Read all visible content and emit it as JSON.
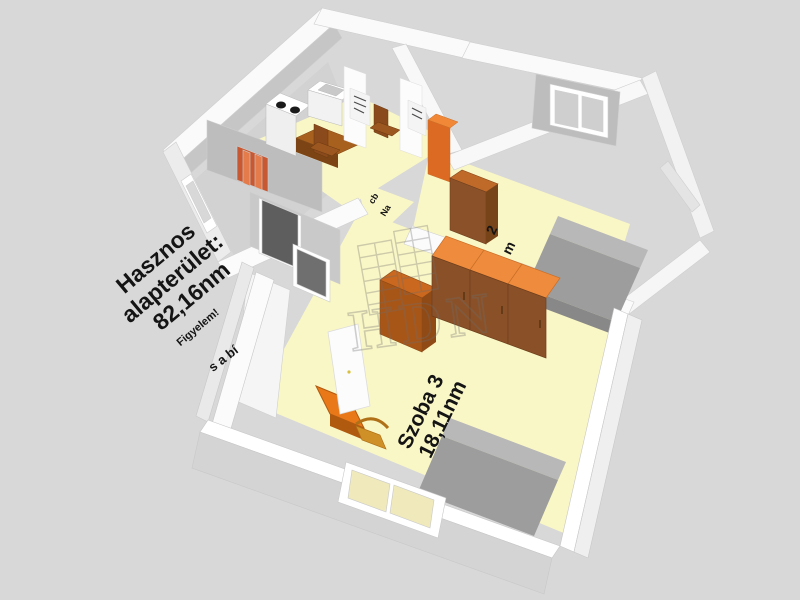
{
  "scene": {
    "background": "#D8D8D8",
    "description": "3D apartment floor plan render"
  },
  "labels": {
    "main_area": {
      "line1": "Hasznos",
      "line2": "alapterület:",
      "line3": "82,16nm"
    },
    "warning": "Figyelem!",
    "wall_text_fragment": "s a bí",
    "room3": {
      "name": "Szoba 3",
      "area": "18,11nm"
    },
    "room2_fragment": {
      "char1": "2",
      "char2": "m"
    },
    "hall_fragment": {
      "part1": "cb",
      "part2": "Na"
    }
  },
  "watermark": {
    "text": "HDN"
  },
  "palette": {
    "background": "#D8D8D8",
    "floor_yellow": "#FAF7C6",
    "wall_white": "#FFFFFF",
    "wall_shadow": "#C6C6C6",
    "furniture_orange_top": "#EF8B3D",
    "furniture_brown": "#8A5128",
    "bed_gray": "#9D9D9D",
    "entrance_door_dark": "#5E5E5E",
    "interior_door_red": "#C85832",
    "window_glass_cream": "#EFE9BC"
  }
}
